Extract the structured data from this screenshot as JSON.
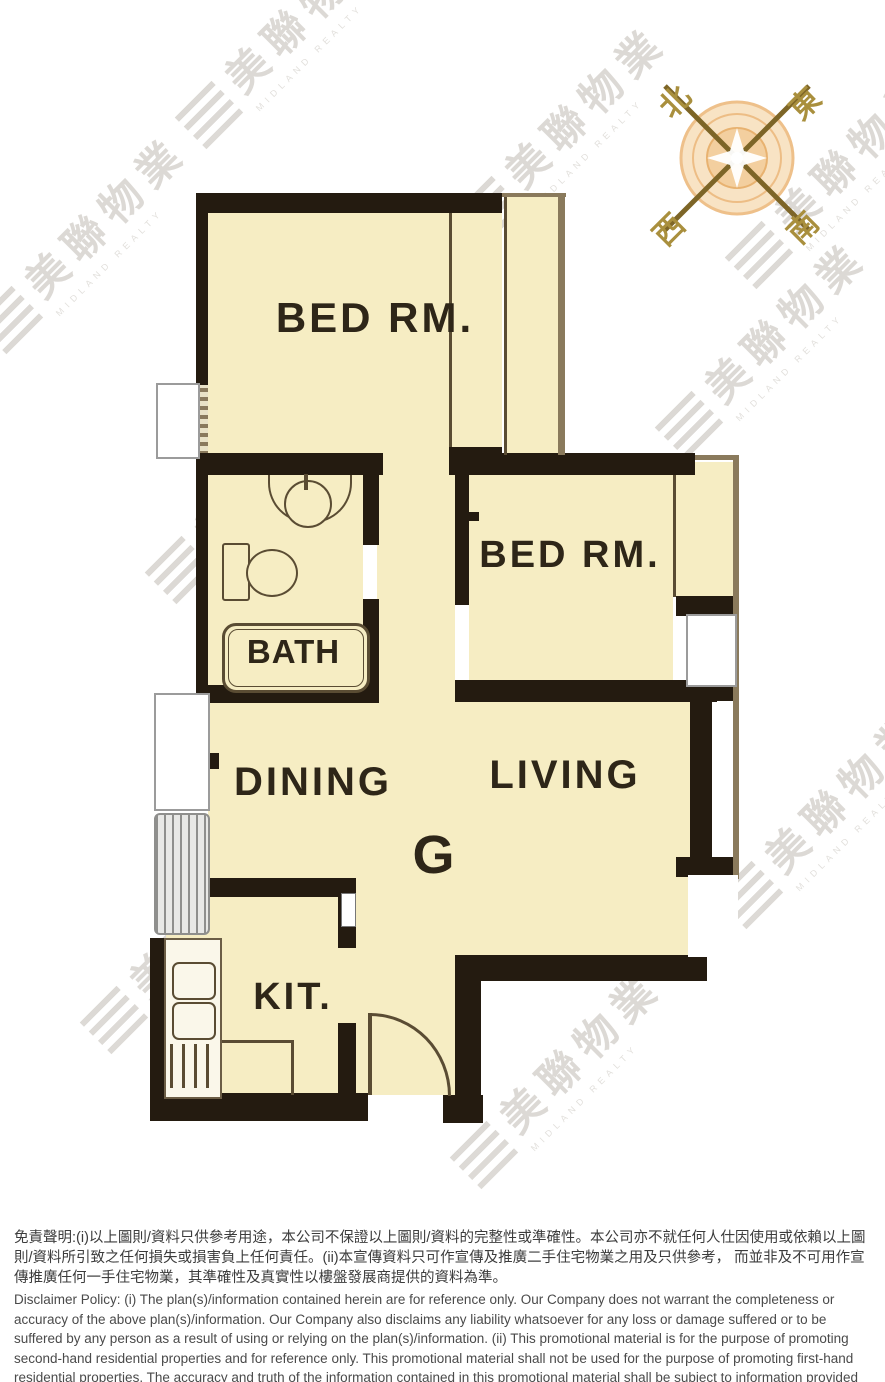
{
  "floor_plan": {
    "unit_label": "G",
    "rooms": {
      "bedroom1": "BED RM.",
      "bedroom2": "BED RM.",
      "bathroom": "BATH",
      "dining": "DINING",
      "living": "LIVING",
      "kitchen": "KIT."
    },
    "colors": {
      "room_fill": "#f6edc3",
      "wall": "#241b10",
      "thin_line": "#5a4c33",
      "compass_orange": "#f0c088"
    }
  },
  "compass": {
    "north": "北",
    "east": "東",
    "west": "西",
    "south": "南"
  },
  "watermark": {
    "zh": "美聯物業",
    "en": "MIDLAND REALTY"
  },
  "disclaimer": {
    "zh": "免責聲明:(i)以上圖則/資料只供參考用途，本公司不保證以上圖則/資料的完整性或準確性。本公司亦不就任何人仕因使用或依賴以上圖則/資料所引致之任何損失或損害負上任何責任。(ii)本宣傳資料只可作宣傳及推廣二手住宅物業之用及只供參考， 而並非及不可用作宣傳推廣任何一手住宅物業，其準確性及真實性以樓盤發展商提供的資料為準。",
    "en": "Disclaimer Policy: (i) The plan(s)/information contained herein are for reference only. Our Company does not warrant the completeness or accuracy of the above plan(s)/information. Our Company also disclaims any liability whatsoever for any loss or damage suffered or to be suffered by any person as a result of using or relying on the plan(s)/information. (ii) This promotional material is for the purpose of promoting second-hand residential properties and for reference only. This promotional material shall not be used for the purpose of promoting first-hand residential properties. The accuracy and truth of the information contained in this promotional material shall be subject to information provided by the developers."
  }
}
